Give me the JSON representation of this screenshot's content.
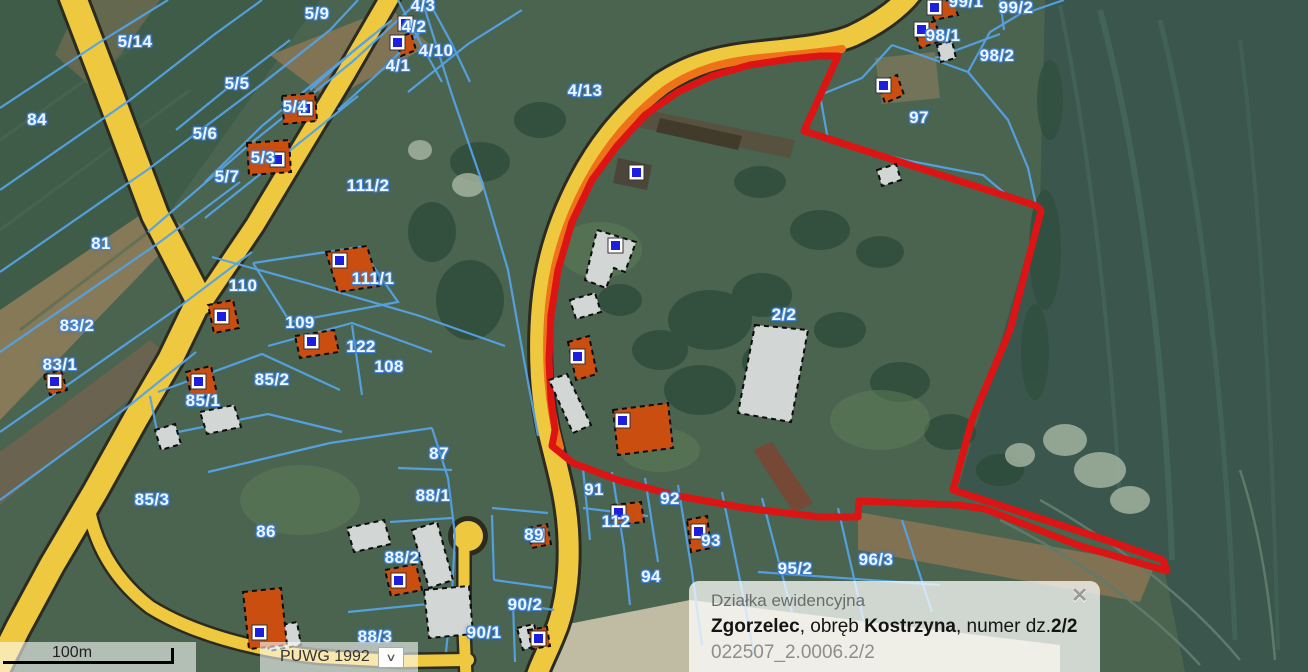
{
  "map": {
    "scale": {
      "label": "100m"
    },
    "projection": {
      "value": "PUWG 1992",
      "chevron_icon": "∨"
    },
    "colors": {
      "road_yellow": "#eec93f",
      "road_casing": "#2b2b22",
      "parcel_blue": "#54a2e4",
      "selected_red": "#dc1414",
      "highlight_orange": "#ee7217",
      "building_orange": "#c94e0f",
      "building_gray": "#d2d6d4",
      "marker_blue": "#1e1edd"
    },
    "labels": [
      {
        "text": "5/14",
        "x": 135,
        "y": 42
      },
      {
        "text": "5/9",
        "x": 317,
        "y": 14
      },
      {
        "text": "4/3",
        "x": 423,
        "y": 6
      },
      {
        "text": "4/2",
        "x": 414,
        "y": 27
      },
      {
        "text": "4/10",
        "x": 436,
        "y": 51
      },
      {
        "text": "4/1",
        "x": 398,
        "y": 66
      },
      {
        "text": "4/13",
        "x": 585,
        "y": 91
      },
      {
        "text": "84",
        "x": 37,
        "y": 120
      },
      {
        "text": "5/5",
        "x": 237,
        "y": 84
      },
      {
        "text": "5/4",
        "x": 295,
        "y": 107
      },
      {
        "text": "5/6",
        "x": 205,
        "y": 134
      },
      {
        "text": "5/3",
        "x": 263,
        "y": 158
      },
      {
        "text": "5/7",
        "x": 227,
        "y": 177
      },
      {
        "text": "111/2",
        "x": 368,
        "y": 186
      },
      {
        "text": "81",
        "x": 101,
        "y": 244
      },
      {
        "text": "110",
        "x": 243,
        "y": 286
      },
      {
        "text": "111/1",
        "x": 373,
        "y": 279
      },
      {
        "text": "83/2",
        "x": 77,
        "y": 326
      },
      {
        "text": "109",
        "x": 300,
        "y": 323
      },
      {
        "text": "122",
        "x": 361,
        "y": 347
      },
      {
        "text": "108",
        "x": 389,
        "y": 367
      },
      {
        "text": "83/1",
        "x": 60,
        "y": 365
      },
      {
        "text": "85/2",
        "x": 272,
        "y": 380
      },
      {
        "text": "85/1",
        "x": 203,
        "y": 401
      },
      {
        "text": "87",
        "x": 439,
        "y": 454
      },
      {
        "text": "85/3",
        "x": 152,
        "y": 500
      },
      {
        "text": "86",
        "x": 266,
        "y": 532
      },
      {
        "text": "88/1",
        "x": 433,
        "y": 496
      },
      {
        "text": "88/2",
        "x": 402,
        "y": 558
      },
      {
        "text": "89",
        "x": 534,
        "y": 535
      },
      {
        "text": "88/3",
        "x": 375,
        "y": 637
      },
      {
        "text": "90/2",
        "x": 525,
        "y": 605
      },
      {
        "text": "90/1",
        "x": 484,
        "y": 633
      },
      {
        "text": "91",
        "x": 594,
        "y": 490
      },
      {
        "text": "92",
        "x": 670,
        "y": 499
      },
      {
        "text": "112",
        "x": 616,
        "y": 522
      },
      {
        "text": "93",
        "x": 711,
        "y": 541
      },
      {
        "text": "94",
        "x": 651,
        "y": 577
      },
      {
        "text": "95/2",
        "x": 795,
        "y": 569
      },
      {
        "text": "96/3",
        "x": 876,
        "y": 560
      },
      {
        "text": "97",
        "x": 919,
        "y": 118
      },
      {
        "text": "98/1",
        "x": 943,
        "y": 36
      },
      {
        "text": "98/2",
        "x": 997,
        "y": 56
      },
      {
        "text": "99/2",
        "x": 1016,
        "y": 8
      },
      {
        "text": "99/1",
        "x": 966,
        "y": 2
      },
      {
        "text": "2/2",
        "x": 784,
        "y": 315
      }
    ]
  },
  "popup": {
    "title": "Działka ewidencyjna",
    "municipality": "Zgorzelec",
    "sep1": ", obręb ",
    "district": "Kostrzyna",
    "sep2": ", numer dz.",
    "parcel": "2/2",
    "identifier": "022507_2.0006.2/2",
    "close_icon": "✕"
  }
}
